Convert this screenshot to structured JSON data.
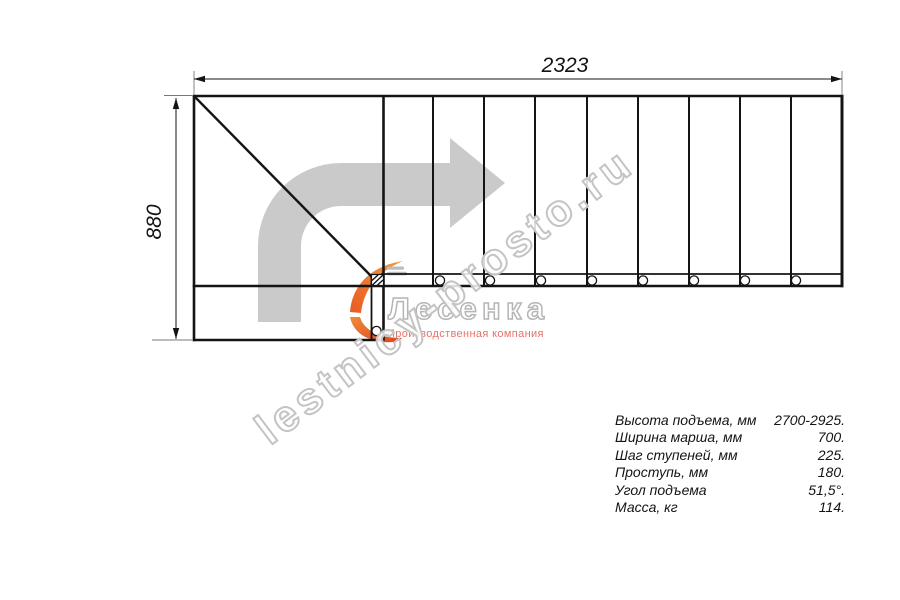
{
  "drawing": {
    "dim_width": "2323",
    "dim_height": "880",
    "treads_count": 9,
    "mount_circles_count": 9,
    "direction_arrow": "turn-right-arrow"
  },
  "watermark": {
    "url_text": "lestnicy-prosto.ru",
    "logo_name": "Лесенка",
    "logo_tagline": "Производственная компания"
  },
  "specs": {
    "rows": [
      {
        "label": "Высота подъема, мм",
        "value": "2700-2925."
      },
      {
        "label": "Ширина марша, мм",
        "value": "700."
      },
      {
        "label": "Шаг ступеней, мм",
        "value": "225."
      },
      {
        "label": "Проступь, мм",
        "value": "180."
      },
      {
        "label": "Угол подъема",
        "value": "51,5°."
      },
      {
        "label": "Масса, кг",
        "value": "114."
      }
    ]
  },
  "colors": {
    "line": "#141414",
    "arrow_gray": "#cacaca",
    "watermark_gray": "#c4c4c4",
    "logo_orange": "#ef7f35",
    "logo_red": "#e2532a",
    "tagline_red": "#e4736a",
    "background": "#ffffff"
  }
}
